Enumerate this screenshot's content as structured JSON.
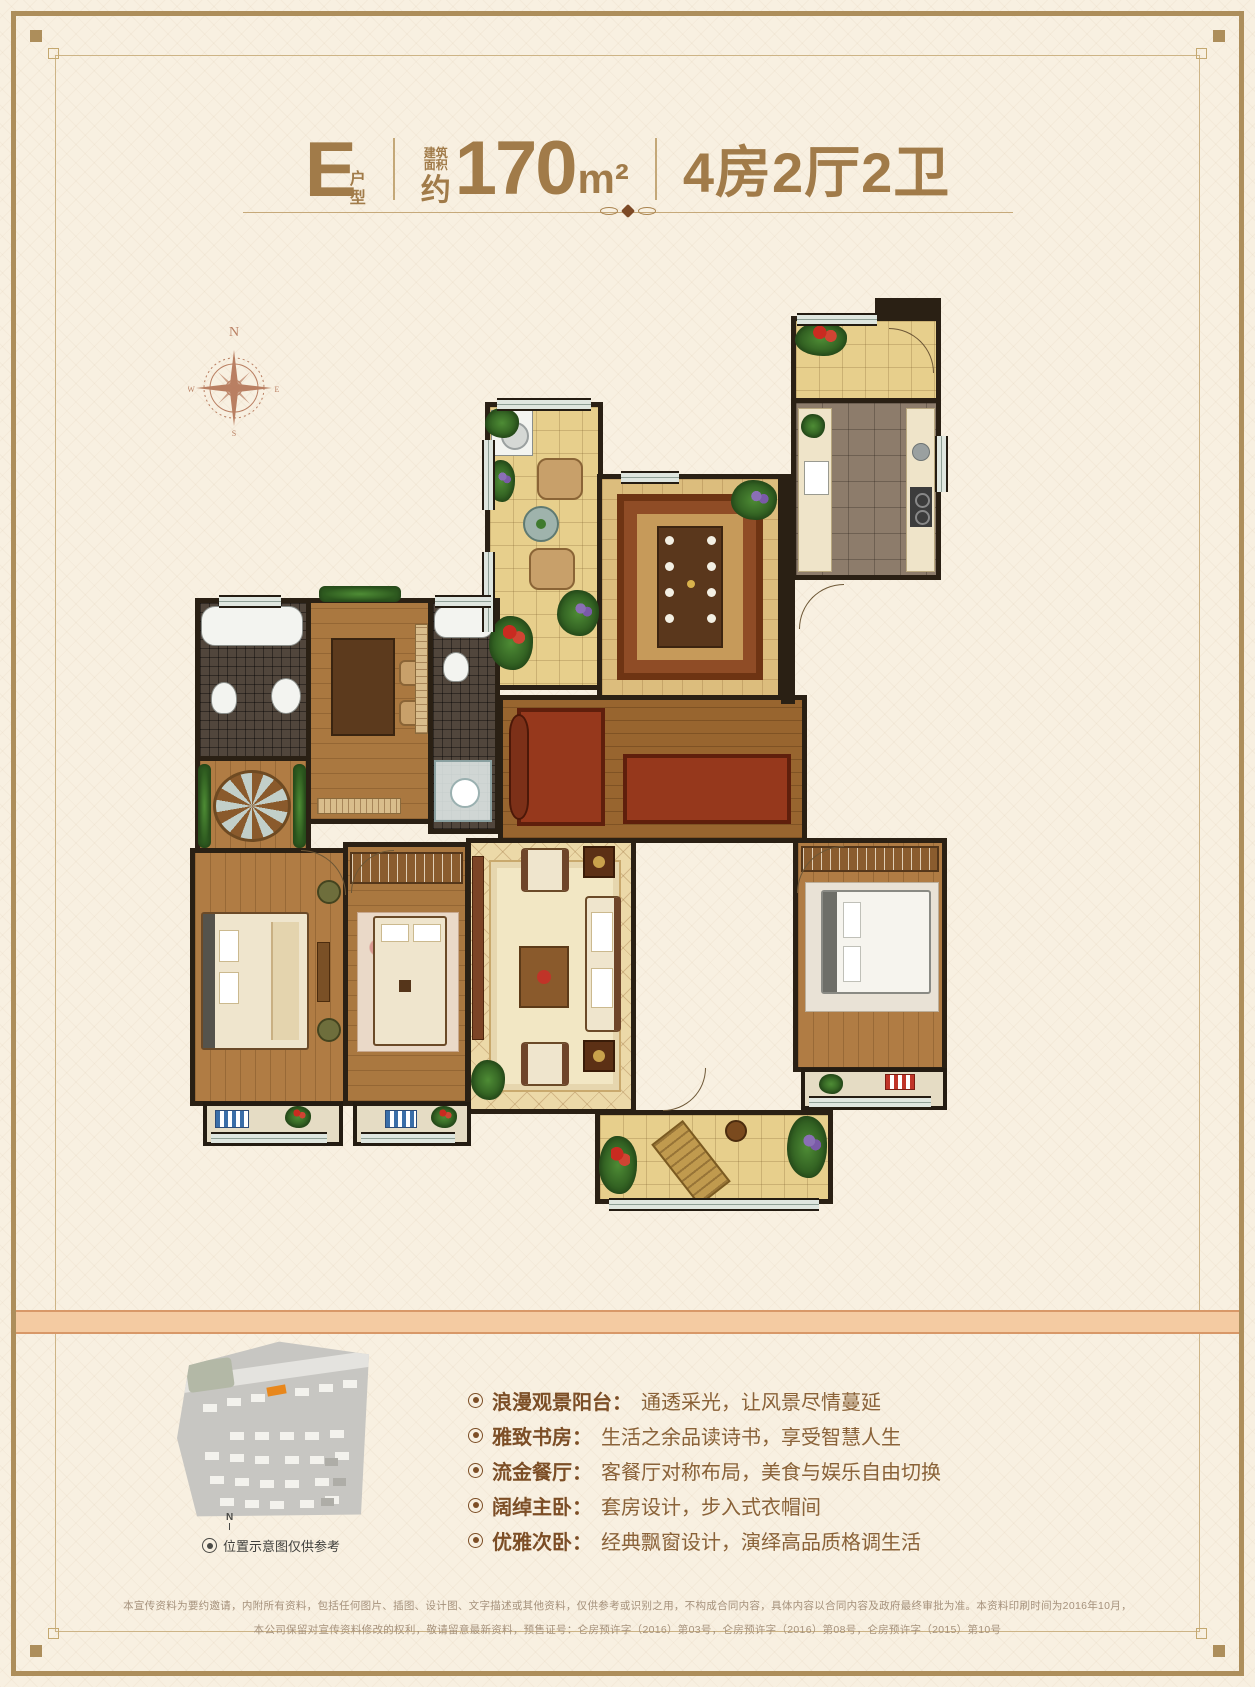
{
  "header": {
    "type_letter": "E",
    "type_suffix": "户型",
    "area_label_top": "建筑",
    "area_label_bottom": "面积",
    "area_approx": "约",
    "area_value": "170",
    "area_unit": "m²",
    "layout_text": "4房2厅2卫"
  },
  "compass": {
    "north": "N",
    "east": "E",
    "south": "S",
    "west": "W"
  },
  "features": [
    {
      "title": "浪漫观景阳台：",
      "desc": "通透采光，让风景尽情蔓延"
    },
    {
      "title": "雅致书房：",
      "desc": "生活之余品读诗书，享受智慧人生"
    },
    {
      "title": "流金餐厅：",
      "desc": "客餐厅对称布局，美食与娱乐自由切换"
    },
    {
      "title": "阔绰主卧：",
      "desc": "套房设计，步入式衣帽间"
    },
    {
      "title": "优雅次卧：",
      "desc": "经典飘窗设计，演绎高品质格调生活"
    }
  ],
  "sitemap": {
    "north_label": "N",
    "caption": "位置示意图仅供参考"
  },
  "disclaimer": {
    "line1": "本宣传资料为要约邀请，内附所有资料，包括任何图片、插图、设计图、文字描述或其他资料，仅供参考或识别之用，不构成合同内容，具体内容以合同内容及政府最终审批为准。本资料印刷时间为2016年10月，",
    "line2": "本公司保留对宣传资料修改的权利，敬请留意最新资料，预售证号：仑房预许字（2016）第03号，仑房预许字（2016）第08号，仑房预许字（2015）第10号"
  },
  "colors": {
    "accent_brown": "#a17b49",
    "deep_brown": "#7c4e26",
    "band_peach": "#f4cba2",
    "frame_gold": "#ad8e5b",
    "wall_dark": "#2a2014",
    "sitemap_highlight": "#e8871c"
  }
}
